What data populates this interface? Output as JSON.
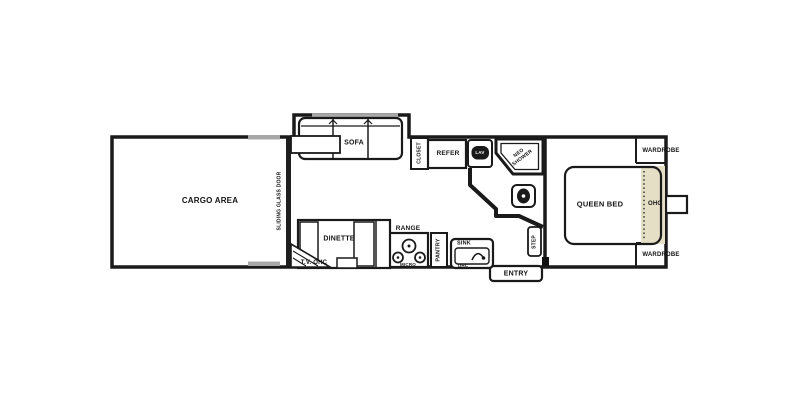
{
  "floorplan": {
    "labels": {
      "cargo_area": "CARGO AREA",
      "sliding_glass_door": "SLIDING GLASS DOOR",
      "sofa": "SOFA",
      "closet": "CLOSET",
      "refer": "REFER",
      "lav": "LAV",
      "neo_shower": "NEO SHOWER",
      "dinette": "DINETTE",
      "tv_ohc": "T.V. OHC",
      "range": "RANGE",
      "micro": "MICRO",
      "pantry": "PANTRY",
      "sink": "SINK",
      "sink_ohc": "OHC",
      "step": "STEP",
      "entry": "ENTRY",
      "queen_bed": "QUEEN BED",
      "bed_ohc": "OHC",
      "wardrobe_front": "WARDROBE",
      "wardrobe_rear": "WARDROBE"
    },
    "icons": {
      "toilet": "toilet-icon",
      "lav_basin": "lav-basin-icon",
      "range_burners": "range-burners-icon",
      "sink_faucet": "sink-faucet-icon",
      "shower_pan": "shower-pan-icon"
    },
    "colors": {
      "line": "#1a1a1a",
      "cabinet_beige": "#e5dfc6",
      "window_gray": "#a8a8a8",
      "background": "#ffffff"
    }
  }
}
